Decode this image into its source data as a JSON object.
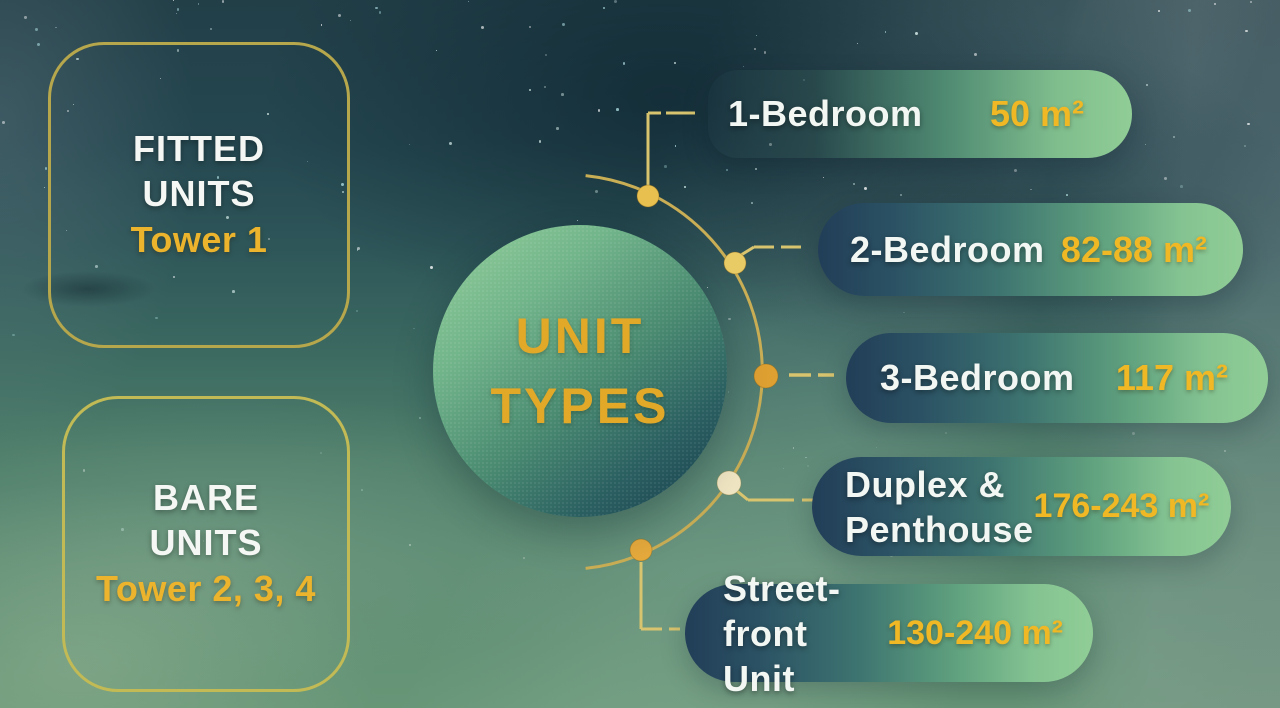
{
  "left_boxes": [
    {
      "title_line1": "FITTED",
      "title_line2": "UNITS",
      "subtitle": "Tower 1"
    },
    {
      "title_line1": "BARE",
      "title_line2": "UNITS",
      "subtitle": "Tower 2, 3, 4"
    }
  ],
  "center_circle": {
    "title_line1": "UNIT",
    "title_line2": "TYPES"
  },
  "unit_types": [
    {
      "label_line1": "1-Bedroom",
      "label_line2": "",
      "area": "50 m²"
    },
    {
      "label_line1": "2-Bedroom",
      "label_line2": "",
      "area": "82-88 m²"
    },
    {
      "label_line1": "3-Bedroom",
      "label_line2": "",
      "area": "117 m²"
    },
    {
      "label_line1": "Duplex &",
      "label_line2": "Penthouse",
      "area": "176-243 m²"
    },
    {
      "label_line1": "Street-front",
      "label_line2": "Unit",
      "area": "130-240 m²"
    }
  ],
  "colors": {
    "accent_gold": "#e8b42c",
    "value_gold": "#f0b824",
    "label_white": "#f3f7f3",
    "box_border_gold": "#b6a74c",
    "pill_dark_end": "#223e58",
    "pill_light_end": "#90cd96",
    "orbit_line_gold": "#cfb35e",
    "background_top": "#223f48",
    "background_bottom": "#679677"
  }
}
